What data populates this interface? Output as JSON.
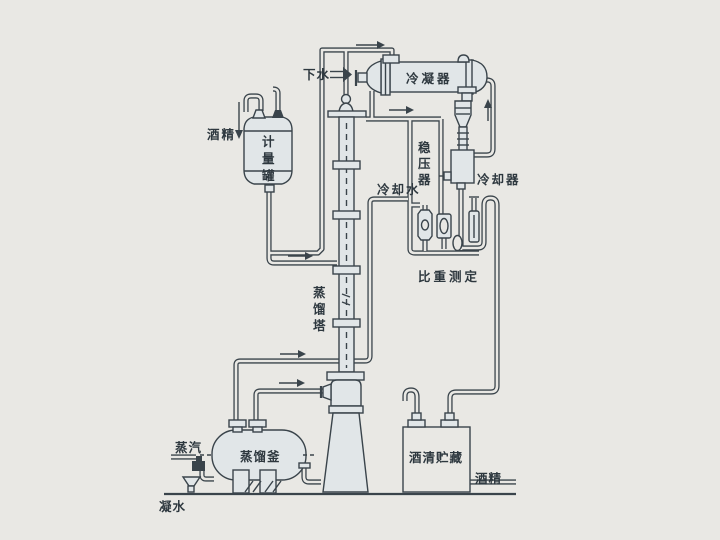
{
  "diagram": {
    "labels": {
      "xia_shui": "下水",
      "leng_ning_qi": "冷凝器",
      "wen_ya_qi": "稳压器",
      "leng_que_qi": "冷却器",
      "leng_que_shui": "冷却水",
      "bi_zhong_ce_ding": "比重测定",
      "jiu_jing_feed": "酒精",
      "ji_liang_guan": "计量罐",
      "zheng_liu_ta": "蒸馏塔",
      "zheng_liu_fu": "蒸馏釜",
      "zheng_qi": "蒸汽",
      "ning_shui": "凝水",
      "jiu_qing_zhu_cang": "酒清贮藏",
      "jiu_jing_out": "酒精"
    },
    "colors": {
      "background": "#e9e8e4",
      "line": "#3a444b",
      "vessel": "#e1e6e8",
      "label": "#2e383f"
    }
  }
}
